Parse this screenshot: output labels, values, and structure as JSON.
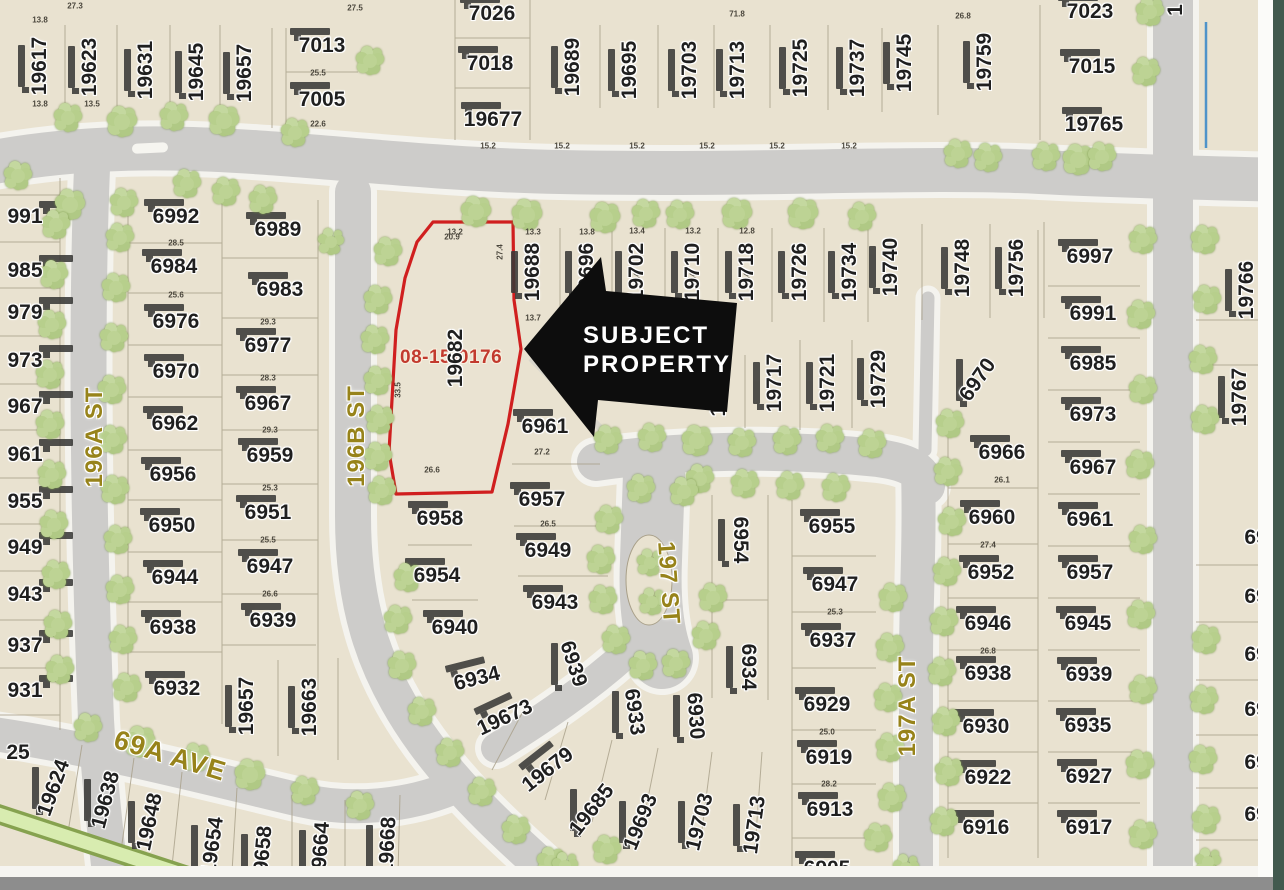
{
  "map": {
    "background": "#e9e2d0",
    "road_color": "#cdccca",
    "road_casing": "#f4f3ee",
    "building_color": "#3a3a38",
    "lot_line_color": "#a89f88",
    "tree_fill": "#bdd394",
    "street_label_color": "#97831a",
    "parcel_label_color": "#1f1f1f",
    "bottom_bar_color": "#8d8d8d",
    "edge_strip_color": "#42594e",
    "water_line_color": "#4f93c9",
    "greenbelt_fill": "#d8ecb0",
    "greenbelt_edge": "#86a24f"
  },
  "subject": {
    "id_label": "08-15-0176",
    "id_color": "#c23a2e",
    "lot_label": "19682",
    "outline_color": "#d01f1f",
    "callout": {
      "line1": "SUBJECT",
      "line2": "PROPERTY",
      "text_color": "#ffffff",
      "arrow_color": "#0d0d0d"
    }
  },
  "streets": [
    [
      "196A ST",
      95,
      437,
      -90
    ],
    [
      "196B ST",
      357,
      436,
      -90
    ],
    [
      "197 ST",
      668,
      583,
      86
    ],
    [
      "197A ST",
      908,
      706,
      -90
    ],
    [
      "69A AVE",
      170,
      756,
      17
    ]
  ],
  "parcels": [
    [
      "19617",
      40,
      66,
      -90
    ],
    [
      "19623",
      90,
      67,
      -90
    ],
    [
      "19631",
      146,
      70,
      -90
    ],
    [
      "19645",
      197,
      72,
      -90
    ],
    [
      "19657",
      245,
      73,
      -90
    ],
    [
      "7013",
      322,
      46,
      0
    ],
    [
      "7005",
      322,
      100,
      0
    ],
    [
      "7026",
      492,
      14,
      0
    ],
    [
      "7018",
      490,
      64,
      0
    ],
    [
      "19677",
      493,
      120,
      0
    ],
    [
      "19689",
      573,
      67,
      -90
    ],
    [
      "19695",
      630,
      70,
      -90
    ],
    [
      "19703",
      690,
      70,
      -90
    ],
    [
      "19713",
      738,
      70,
      -90
    ],
    [
      "19725",
      801,
      68,
      -90
    ],
    [
      "19737",
      858,
      68,
      -90
    ],
    [
      "19745",
      905,
      63,
      -90
    ],
    [
      "19759",
      985,
      62,
      -90
    ],
    [
      "7023",
      1090,
      12,
      0
    ],
    [
      "7015",
      1092,
      67,
      0
    ],
    [
      "19765",
      1094,
      125,
      0
    ],
    [
      "1",
      1176,
      10,
      -90
    ],
    [
      "19766",
      1247,
      290,
      -90
    ],
    [
      "19767",
      1240,
      397,
      -90
    ],
    [
      "69",
      1256,
      538,
      0
    ],
    [
      "69",
      1256,
      597,
      0
    ],
    [
      "69",
      1256,
      655,
      0
    ],
    [
      "69",
      1256,
      710,
      0
    ],
    [
      "69",
      1256,
      763,
      0
    ],
    [
      "69",
      1256,
      815,
      0
    ],
    [
      "991",
      25,
      217,
      0
    ],
    [
      "985",
      25,
      271,
      0
    ],
    [
      "979",
      25,
      313,
      0
    ],
    [
      "973",
      25,
      361,
      0
    ],
    [
      "967",
      25,
      407,
      0
    ],
    [
      "961",
      25,
      455,
      0
    ],
    [
      "955",
      25,
      502,
      0
    ],
    [
      "949",
      25,
      548,
      0
    ],
    [
      "943",
      25,
      595,
      0
    ],
    [
      "937",
      25,
      646,
      0
    ],
    [
      "931",
      25,
      691,
      0
    ],
    [
      "25",
      18,
      753,
      0
    ],
    [
      "6992",
      176,
      217,
      0
    ],
    [
      "6984",
      174,
      267,
      0
    ],
    [
      "6976",
      176,
      322,
      0
    ],
    [
      "6970",
      176,
      372,
      0
    ],
    [
      "6962",
      175,
      424,
      0
    ],
    [
      "6956",
      173,
      475,
      0
    ],
    [
      "6950",
      172,
      526,
      0
    ],
    [
      "6944",
      175,
      578,
      0
    ],
    [
      "6938",
      173,
      628,
      0
    ],
    [
      "6932",
      177,
      689,
      0
    ],
    [
      "6989",
      278,
      230,
      0
    ],
    [
      "6983",
      280,
      290,
      0
    ],
    [
      "6977",
      268,
      346,
      0
    ],
    [
      "6967",
      268,
      404,
      0
    ],
    [
      "6959",
      270,
      456,
      0
    ],
    [
      "6951",
      268,
      513,
      0
    ],
    [
      "6947",
      270,
      567,
      0
    ],
    [
      "6939",
      273,
      621,
      0
    ],
    [
      "19657",
      247,
      706,
      -90
    ],
    [
      "19663",
      310,
      707,
      -90
    ],
    [
      "19688",
      533,
      272,
      -90
    ],
    [
      "19696",
      587,
      272,
      -90
    ],
    [
      "19702",
      637,
      272,
      -90
    ],
    [
      "19710",
      693,
      272,
      -90
    ],
    [
      "19718",
      747,
      272,
      -90
    ],
    [
      "19726",
      800,
      272,
      -90
    ],
    [
      "19734",
      850,
      272,
      -90
    ],
    [
      "19740",
      891,
      267,
      -90
    ],
    [
      "19748",
      963,
      268,
      -90
    ],
    [
      "19756",
      1017,
      268,
      -90
    ],
    [
      "19",
      719,
      405,
      -90
    ],
    [
      "19717",
      775,
      383,
      -90
    ],
    [
      "19721",
      828,
      383,
      -90
    ],
    [
      "19729",
      879,
      379,
      -90
    ],
    [
      "6997",
      1090,
      257,
      0
    ],
    [
      "6991",
      1093,
      314,
      0
    ],
    [
      "6985",
      1093,
      364,
      0
    ],
    [
      "6973",
      1093,
      415,
      0
    ],
    [
      "6967",
      1093,
      468,
      0
    ],
    [
      "6961",
      1090,
      520,
      0
    ],
    [
      "6957",
      1090,
      573,
      0
    ],
    [
      "6945",
      1088,
      624,
      0
    ],
    [
      "6939",
      1089,
      675,
      0
    ],
    [
      "6935",
      1088,
      726,
      0
    ],
    [
      "6927",
      1089,
      777,
      0
    ],
    [
      "6917",
      1089,
      828,
      0
    ],
    [
      "6970",
      978,
      380,
      -55
    ],
    [
      "6966",
      1002,
      453,
      0
    ],
    [
      "6960",
      992,
      518,
      0
    ],
    [
      "6952",
      991,
      573,
      0
    ],
    [
      "6946",
      988,
      624,
      0
    ],
    [
      "6938",
      988,
      674,
      0
    ],
    [
      "6930",
      986,
      727,
      0
    ],
    [
      "6922",
      988,
      778,
      0
    ],
    [
      "6916",
      986,
      828,
      0
    ],
    [
      "6955",
      832,
      527,
      0
    ],
    [
      "6947",
      835,
      585,
      0
    ],
    [
      "6937",
      833,
      641,
      0
    ],
    [
      "6929",
      827,
      705,
      0
    ],
    [
      "6919",
      829,
      758,
      0
    ],
    [
      "6913",
      830,
      810,
      0
    ],
    [
      "6905",
      827,
      869,
      0
    ],
    [
      "6954",
      740,
      540,
      90
    ],
    [
      "6934",
      748,
      667,
      90
    ],
    [
      "6961",
      545,
      427,
      0
    ],
    [
      "6957",
      542,
      500,
      0
    ],
    [
      "6949",
      548,
      551,
      0
    ],
    [
      "6943",
      555,
      603,
      0
    ],
    [
      "6939",
      573,
      664,
      72
    ],
    [
      "6958",
      440,
      519,
      0
    ],
    [
      "6954",
      437,
      576,
      0
    ],
    [
      "6940",
      455,
      628,
      0
    ],
    [
      "6934",
      477,
      679,
      -14
    ],
    [
      "19673",
      505,
      718,
      -25
    ],
    [
      "19679",
      548,
      770,
      -38
    ],
    [
      "19685",
      592,
      810,
      -52
    ],
    [
      "19693",
      641,
      822,
      -68
    ],
    [
      "19703",
      700,
      822,
      -76
    ],
    [
      "19713",
      755,
      825,
      -82
    ],
    [
      "6933",
      634,
      712,
      82
    ],
    [
      "6930",
      695,
      716,
      86
    ],
    [
      "19624",
      54,
      788,
      -70
    ],
    [
      "19638",
      106,
      800,
      -75
    ],
    [
      "19648",
      150,
      822,
      -78
    ],
    [
      "19654",
      213,
      846,
      -82
    ],
    [
      "19658",
      263,
      855,
      -85
    ],
    [
      "19664",
      321,
      851,
      -86
    ],
    [
      "19668",
      388,
      846,
      -87
    ]
  ],
  "dims": [
    [
      75,
      6,
      "27.3",
      0
    ],
    [
      355,
      8,
      "27.5",
      0
    ],
    [
      737,
      14,
      "71.8",
      0
    ],
    [
      963,
      16,
      "26.8",
      0
    ],
    [
      40,
      20,
      "13.8",
      0
    ],
    [
      40,
      104,
      "13.8",
      0
    ],
    [
      92,
      104,
      "13.5",
      0
    ],
    [
      318,
      73,
      "25.5",
      0
    ],
    [
      318,
      124,
      "22.6",
      0
    ],
    [
      488,
      146,
      "15.2",
      0
    ],
    [
      562,
      146,
      "15.2",
      0
    ],
    [
      637,
      146,
      "15.2",
      0
    ],
    [
      707,
      146,
      "15.2",
      0
    ],
    [
      777,
      146,
      "15.2",
      0
    ],
    [
      849,
      146,
      "15.2",
      0
    ],
    [
      176,
      243,
      "28.5",
      0
    ],
    [
      176,
      295,
      "25.6",
      0
    ],
    [
      268,
      322,
      "29.3",
      0
    ],
    [
      268,
      378,
      "28.3",
      0
    ],
    [
      270,
      430,
      "29.3",
      0
    ],
    [
      270,
      488,
      "25.3",
      0
    ],
    [
      268,
      540,
      "25.5",
      0
    ],
    [
      270,
      594,
      "26.6",
      0
    ],
    [
      455,
      232,
      "13.2",
      0
    ],
    [
      533,
      232,
      "13.3",
      0
    ],
    [
      587,
      232,
      "13.8",
      0
    ],
    [
      637,
      231,
      "13.4",
      0
    ],
    [
      693,
      231,
      "13.2",
      0
    ],
    [
      747,
      231,
      "12.8",
      0
    ],
    [
      587,
      280,
      "27.4",
      -90
    ],
    [
      637,
      280,
      "27.4",
      -90
    ],
    [
      693,
      280,
      "27.4",
      -90
    ],
    [
      747,
      280,
      "27.4",
      -90
    ],
    [
      452,
      237,
      "20.9",
      0
    ],
    [
      432,
      470,
      "26.6",
      0
    ],
    [
      398,
      390,
      "33.5",
      -90
    ],
    [
      500,
      252,
      "27.4",
      -90
    ],
    [
      542,
      452,
      "27.2",
      0
    ],
    [
      548,
      524,
      "26.5",
      0
    ],
    [
      835,
      612,
      "25.3",
      0
    ],
    [
      827,
      732,
      "25.0",
      0
    ],
    [
      829,
      784,
      "28.2",
      0
    ],
    [
      988,
      545,
      "27.4",
      0
    ],
    [
      1002,
      480,
      "26.1",
      0
    ],
    [
      988,
      651,
      "26.8",
      0
    ],
    [
      533,
      318,
      "13.7",
      0
    ],
    [
      588,
      318,
      "13.7",
      0
    ]
  ],
  "trees": [
    [
      68,
      118,
      26
    ],
    [
      122,
      122,
      28
    ],
    [
      174,
      117,
      26
    ],
    [
      224,
      121,
      27
    ],
    [
      295,
      133,
      25
    ],
    [
      370,
      61,
      26
    ],
    [
      1150,
      12,
      24
    ],
    [
      1146,
      72,
      26
    ],
    [
      18,
      176,
      26
    ],
    [
      70,
      205,
      28
    ],
    [
      124,
      203,
      26
    ],
    [
      187,
      184,
      26
    ],
    [
      226,
      192,
      26
    ],
    [
      263,
      200,
      25
    ],
    [
      476,
      212,
      28
    ],
    [
      527,
      215,
      27
    ],
    [
      605,
      218,
      30
    ],
    [
      646,
      214,
      26
    ],
    [
      680,
      215,
      26
    ],
    [
      737,
      214,
      28
    ],
    [
      803,
      214,
      27
    ],
    [
      862,
      217,
      26
    ],
    [
      958,
      154,
      26
    ],
    [
      988,
      158,
      25
    ],
    [
      1046,
      157,
      26
    ],
    [
      1078,
      160,
      27
    ],
    [
      1102,
      157,
      24
    ],
    [
      608,
      440,
      26
    ],
    [
      652,
      438,
      26
    ],
    [
      697,
      441,
      27
    ],
    [
      742,
      443,
      26
    ],
    [
      787,
      441,
      26
    ],
    [
      830,
      439,
      25
    ],
    [
      872,
      444,
      24
    ],
    [
      700,
      479,
      25
    ],
    [
      745,
      484,
      26
    ],
    [
      790,
      486,
      26
    ],
    [
      836,
      488,
      25
    ],
    [
      378,
      300,
      24
    ],
    [
      375,
      340,
      25
    ],
    [
      378,
      381,
      24
    ],
    [
      380,
      420,
      25
    ],
    [
      378,
      457,
      24
    ],
    [
      382,
      491,
      24
    ],
    [
      388,
      252,
      24
    ],
    [
      331,
      242,
      23
    ],
    [
      120,
      238,
      25
    ],
    [
      116,
      288,
      24
    ],
    [
      114,
      338,
      25
    ],
    [
      112,
      390,
      24
    ],
    [
      113,
      440,
      25
    ],
    [
      115,
      490,
      24
    ],
    [
      118,
      540,
      25
    ],
    [
      120,
      590,
      24
    ],
    [
      123,
      640,
      25
    ],
    [
      127,
      688,
      24
    ],
    [
      56,
      225,
      24
    ],
    [
      54,
      275,
      25
    ],
    [
      52,
      325,
      24
    ],
    [
      50,
      375,
      25
    ],
    [
      50,
      425,
      24
    ],
    [
      52,
      475,
      25
    ],
    [
      54,
      525,
      24
    ],
    [
      56,
      575,
      25
    ],
    [
      58,
      625,
      24
    ],
    [
      60,
      670,
      24
    ],
    [
      950,
      424,
      25
    ],
    [
      948,
      472,
      26
    ],
    [
      952,
      522,
      25
    ],
    [
      947,
      572,
      25
    ],
    [
      944,
      622,
      24
    ],
    [
      942,
      672,
      25
    ],
    [
      946,
      722,
      25
    ],
    [
      949,
      772,
      24
    ],
    [
      944,
      822,
      25
    ],
    [
      893,
      598,
      24
    ],
    [
      890,
      648,
      24
    ],
    [
      888,
      698,
      25
    ],
    [
      890,
      748,
      24
    ],
    [
      892,
      798,
      24
    ],
    [
      1143,
      240,
      25
    ],
    [
      1141,
      315,
      24
    ],
    [
      1143,
      390,
      25
    ],
    [
      1140,
      465,
      24
    ],
    [
      1143,
      540,
      25
    ],
    [
      1141,
      615,
      24
    ],
    [
      1143,
      690,
      25
    ],
    [
      1140,
      765,
      24
    ],
    [
      1143,
      835,
      24
    ],
    [
      1205,
      240,
      24
    ],
    [
      1207,
      300,
      24
    ],
    [
      1203,
      360,
      25
    ],
    [
      1205,
      420,
      24
    ],
    [
      1206,
      640,
      24
    ],
    [
      1204,
      700,
      25
    ],
    [
      1203,
      760,
      24
    ],
    [
      1206,
      820,
      24
    ],
    [
      1208,
      862,
      22
    ],
    [
      609,
      520,
      25
    ],
    [
      601,
      560,
      24
    ],
    [
      603,
      600,
      24
    ],
    [
      616,
      640,
      25
    ],
    [
      643,
      666,
      24
    ],
    [
      676,
      664,
      24
    ],
    [
      706,
      636,
      25
    ],
    [
      713,
      598,
      24
    ],
    [
      641,
      489,
      24
    ],
    [
      684,
      492,
      24
    ],
    [
      650,
      563,
      20
    ],
    [
      652,
      602,
      20
    ],
    [
      88,
      728,
      26
    ],
    [
      140,
      742,
      27
    ],
    [
      196,
      758,
      26
    ],
    [
      250,
      775,
      27
    ],
    [
      305,
      791,
      26
    ],
    [
      360,
      806,
      25
    ],
    [
      408,
      578,
      25
    ],
    [
      398,
      620,
      25
    ],
    [
      402,
      666,
      24
    ],
    [
      422,
      712,
      25
    ],
    [
      450,
      753,
      25
    ],
    [
      482,
      792,
      25
    ],
    [
      516,
      830,
      25
    ],
    [
      551,
      862,
      24
    ],
    [
      565,
      866,
      22
    ],
    [
      607,
      850,
      24
    ],
    [
      878,
      838,
      25
    ],
    [
      906,
      868,
      22
    ]
  ]
}
